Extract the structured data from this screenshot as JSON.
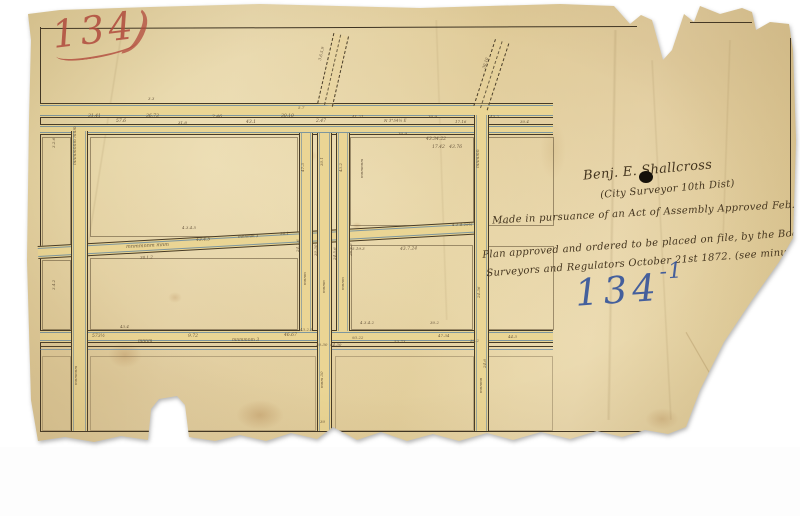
{
  "annotations": {
    "plan_number_red": "134",
    "plan_number_flourish": ")",
    "file_number_blue_main": "134",
    "file_number_blue_sup": "-1",
    "surveyor_signature": "Benj. E. Shallcross",
    "surveyor_title": "(City Surveyor 10th Dist)",
    "pursuance_note": "Made in pursuance of an Act of Assembly Approved Feb. 28th 1871.",
    "approval_note_line1": "Plan approved and ordered to be placed on file, by the Board of",
    "approval_note_line2": "Surveyors and Regulators October 21st 1872. (see minutes)"
  },
  "colors": {
    "paper": "#e6d4a4",
    "ink": "#3c3222",
    "blue_line": "#6d93b4",
    "red_number": "#b4463c",
    "blue_number": "#33539b",
    "street_fill": "#ead594"
  },
  "measurements": [
    {
      "x": 88,
      "y": 115,
      "r": 0,
      "s": 4.5,
      "t": "31.41"
    },
    {
      "x": 116,
      "y": 120,
      "r": 0,
      "s": 4.5,
      "t": "57.6"
    },
    {
      "x": 146,
      "y": 115,
      "r": 0,
      "s": 4.5,
      "t": "36.73"
    },
    {
      "x": 178,
      "y": 121,
      "r": 0,
      "s": 4,
      "t": "31.8"
    },
    {
      "x": 212,
      "y": 116,
      "r": 0,
      "s": 4.5,
      "t": "2.46"
    },
    {
      "x": 246,
      "y": 121,
      "r": 0,
      "s": 4.5,
      "t": "43.1"
    },
    {
      "x": 281,
      "y": 115,
      "r": 0,
      "s": 4.5,
      "t": "30.10"
    },
    {
      "x": 316,
      "y": 120,
      "r": 0,
      "s": 4.5,
      "t": "2.47"
    },
    {
      "x": 352,
      "y": 115,
      "r": 0,
      "s": 4,
      "t": "41.21"
    },
    {
      "x": 384,
      "y": 119,
      "r": -1,
      "s": 4,
      "t": "N 3°54½ E"
    },
    {
      "x": 428,
      "y": 115,
      "r": 0,
      "s": 4,
      "t": "30.9"
    },
    {
      "x": 455,
      "y": 120,
      "r": 0,
      "s": 4,
      "t": "17.16"
    },
    {
      "x": 490,
      "y": 115,
      "r": 0,
      "s": 4,
      "t": "43.2"
    },
    {
      "x": 520,
      "y": 120,
      "r": 0,
      "s": 4,
      "t": "30.4"
    },
    {
      "x": 298,
      "y": 106,
      "r": 0,
      "s": 4,
      "t": "5.7"
    },
    {
      "x": 148,
      "y": 97,
      "r": 0,
      "s": 4,
      "t": "3.3"
    },
    {
      "x": 426,
      "y": 138,
      "r": 0,
      "s": 4.5,
      "t": "43.34.22"
    },
    {
      "x": 432,
      "y": 146,
      "r": 0,
      "s": 4.5,
      "t": "17.42   43.76"
    },
    {
      "x": 398,
      "y": 132,
      "r": 0,
      "s": 4,
      "t": "30.9"
    },
    {
      "x": 318,
      "y": 60,
      "r": -76,
      "s": 4,
      "t": "3.6.5.9"
    },
    {
      "x": 482,
      "y": 68,
      "r": -72,
      "s": 4,
      "t": "30.10"
    },
    {
      "x": 74,
      "y": 165,
      "r": -90,
      "s": 4.5,
      "t": "mnmmnnm mnm"
    },
    {
      "x": 74,
      "y": 385,
      "r": -90,
      "s": 4,
      "t": "mnmnnm"
    },
    {
      "x": 52,
      "y": 148,
      "r": -90,
      "s": 4,
      "t": "3.2.6"
    },
    {
      "x": 52,
      "y": 290,
      "r": -90,
      "s": 4,
      "t": "3.4.2"
    },
    {
      "x": 126,
      "y": 245,
      "r": -3,
      "s": 5,
      "t": "mnmmnnm mnm"
    },
    {
      "x": 196,
      "y": 239,
      "r": -3,
      "s": 4.5,
      "t": "43.4.5"
    },
    {
      "x": 238,
      "y": 235,
      "r": -3,
      "s": 4,
      "t": "mnnmm 3"
    },
    {
      "x": 280,
      "y": 232,
      "r": -3,
      "s": 4,
      "t": "30.1"
    },
    {
      "x": 182,
      "y": 226,
      "r": 0,
      "s": 4,
      "t": "4.3.4.5"
    },
    {
      "x": 140,
      "y": 256,
      "r": -3,
      "s": 4,
      "t": "30.1.2"
    },
    {
      "x": 301,
      "y": 172,
      "r": -90,
      "s": 4,
      "t": "47.3"
    },
    {
      "x": 320,
      "y": 166,
      "r": -90,
      "s": 4,
      "t": "30.1"
    },
    {
      "x": 339,
      "y": 172,
      "r": -90,
      "s": 4,
      "t": "43.2"
    },
    {
      "x": 360,
      "y": 178,
      "r": -90,
      "s": 4,
      "t": "mnmnnm"
    },
    {
      "x": 296,
      "y": 252,
      "r": -90,
      "s": 4,
      "t": "24.1.6"
    },
    {
      "x": 303,
      "y": 285,
      "r": -90,
      "s": 4,
      "t": "mnnm"
    },
    {
      "x": 314,
      "y": 256,
      "r": -90,
      "s": 4,
      "t": "30.30"
    },
    {
      "x": 322,
      "y": 293,
      "r": -90,
      "s": 4,
      "t": "mnmn"
    },
    {
      "x": 333,
      "y": 260,
      "r": -90,
      "s": 4,
      "t": "24.5.6"
    },
    {
      "x": 341,
      "y": 290,
      "r": -90,
      "s": 4,
      "t": "mnnm"
    },
    {
      "x": 349,
      "y": 256,
      "r": -90,
      "s": 4,
      "t": "26.4.6"
    },
    {
      "x": 352,
      "y": 247,
      "r": 0,
      "s": 4,
      "t": "5.19.3"
    },
    {
      "x": 400,
      "y": 248,
      "r": -2,
      "s": 4.5,
      "t": "43.7.24"
    },
    {
      "x": 360,
      "y": 321,
      "r": 0,
      "s": 4,
      "t": "4.3.4.2"
    },
    {
      "x": 430,
      "y": 321,
      "r": 0,
      "s": 4,
      "t": "30.2"
    },
    {
      "x": 477,
      "y": 168,
      "r": -90,
      "s": 4.5,
      "t": "mnmmn"
    },
    {
      "x": 477,
      "y": 298,
      "r": -90,
      "s": 4,
      "t": "24.36"
    },
    {
      "x": 479,
      "y": 393,
      "r": -90,
      "s": 4,
      "t": "mnnmn"
    },
    {
      "x": 452,
      "y": 223,
      "r": 0,
      "s": 4,
      "t": "4.1.4.29½"
    },
    {
      "x": 498,
      "y": 221,
      "r": 0,
      "s": 4,
      "t": "2.7.2"
    },
    {
      "x": 92,
      "y": 335,
      "r": 0,
      "s": 4.5,
      "t": "573½"
    },
    {
      "x": 138,
      "y": 340,
      "r": 0,
      "s": 4.5,
      "t": "mnnm"
    },
    {
      "x": 188,
      "y": 335,
      "r": 0,
      "s": 4.5,
      "t": "9.72"
    },
    {
      "x": 232,
      "y": 339,
      "r": 0,
      "s": 4.5,
      "t": "mnmmnm 3"
    },
    {
      "x": 284,
      "y": 334,
      "r": 0,
      "s": 4.5,
      "t": "46.67"
    },
    {
      "x": 316,
      "y": 343,
      "r": 0,
      "s": 4,
      "t": "30.30  44.30"
    },
    {
      "x": 352,
      "y": 336,
      "r": 0,
      "s": 4,
      "t": "93.22"
    },
    {
      "x": 394,
      "y": 340,
      "r": 0,
      "s": 4,
      "t": "53.73"
    },
    {
      "x": 438,
      "y": 334,
      "r": 0,
      "s": 4,
      "t": "47.34"
    },
    {
      "x": 300,
      "y": 328,
      "r": 0,
      "s": 4,
      "t": "43.2.5"
    },
    {
      "x": 470,
      "y": 339,
      "r": 0,
      "s": 4,
      "t": "30.2"
    },
    {
      "x": 508,
      "y": 335,
      "r": 0,
      "s": 4,
      "t": "44.3"
    },
    {
      "x": 120,
      "y": 325,
      "r": 0,
      "s": 4,
      "t": "43.4"
    },
    {
      "x": 320,
      "y": 388,
      "r": -90,
      "s": 4,
      "t": "mnm 30"
    },
    {
      "x": 320,
      "y": 420,
      "r": 0,
      "s": 4,
      "t": "30"
    },
    {
      "x": 483,
      "y": 368,
      "r": -90,
      "s": 4,
      "t": "24.6"
    }
  ]
}
